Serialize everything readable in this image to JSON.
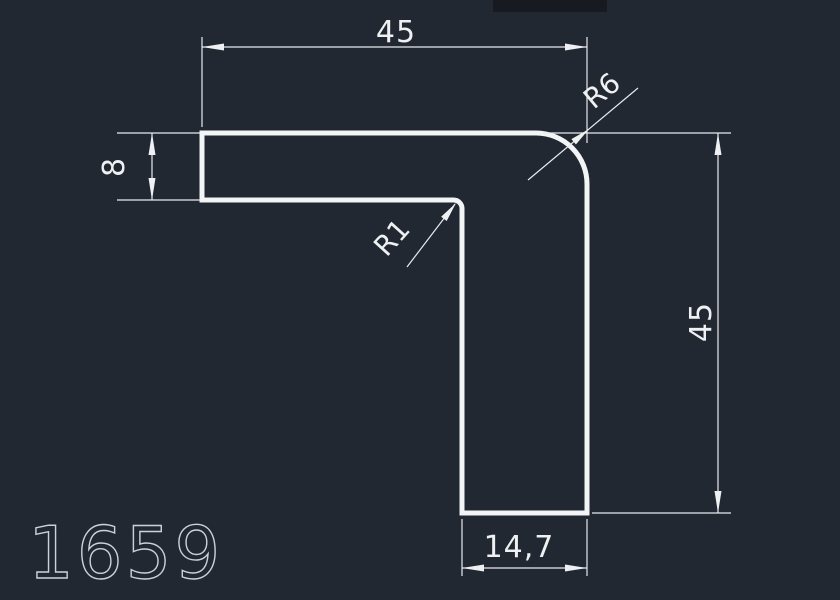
{
  "drawing": {
    "part_number": "1659",
    "dimensions": {
      "top_width": "45",
      "left_thickness": "8",
      "right_height": "45",
      "bottom_width": "14,7",
      "outer_corner_radius": "R6",
      "inner_corner_radius": "R1"
    },
    "colors": {
      "background": "#212832",
      "geometry_line": "#f2f4f6",
      "dimension_line": "#e9ebee",
      "part_number_text": "#ccd1d7"
    }
  }
}
